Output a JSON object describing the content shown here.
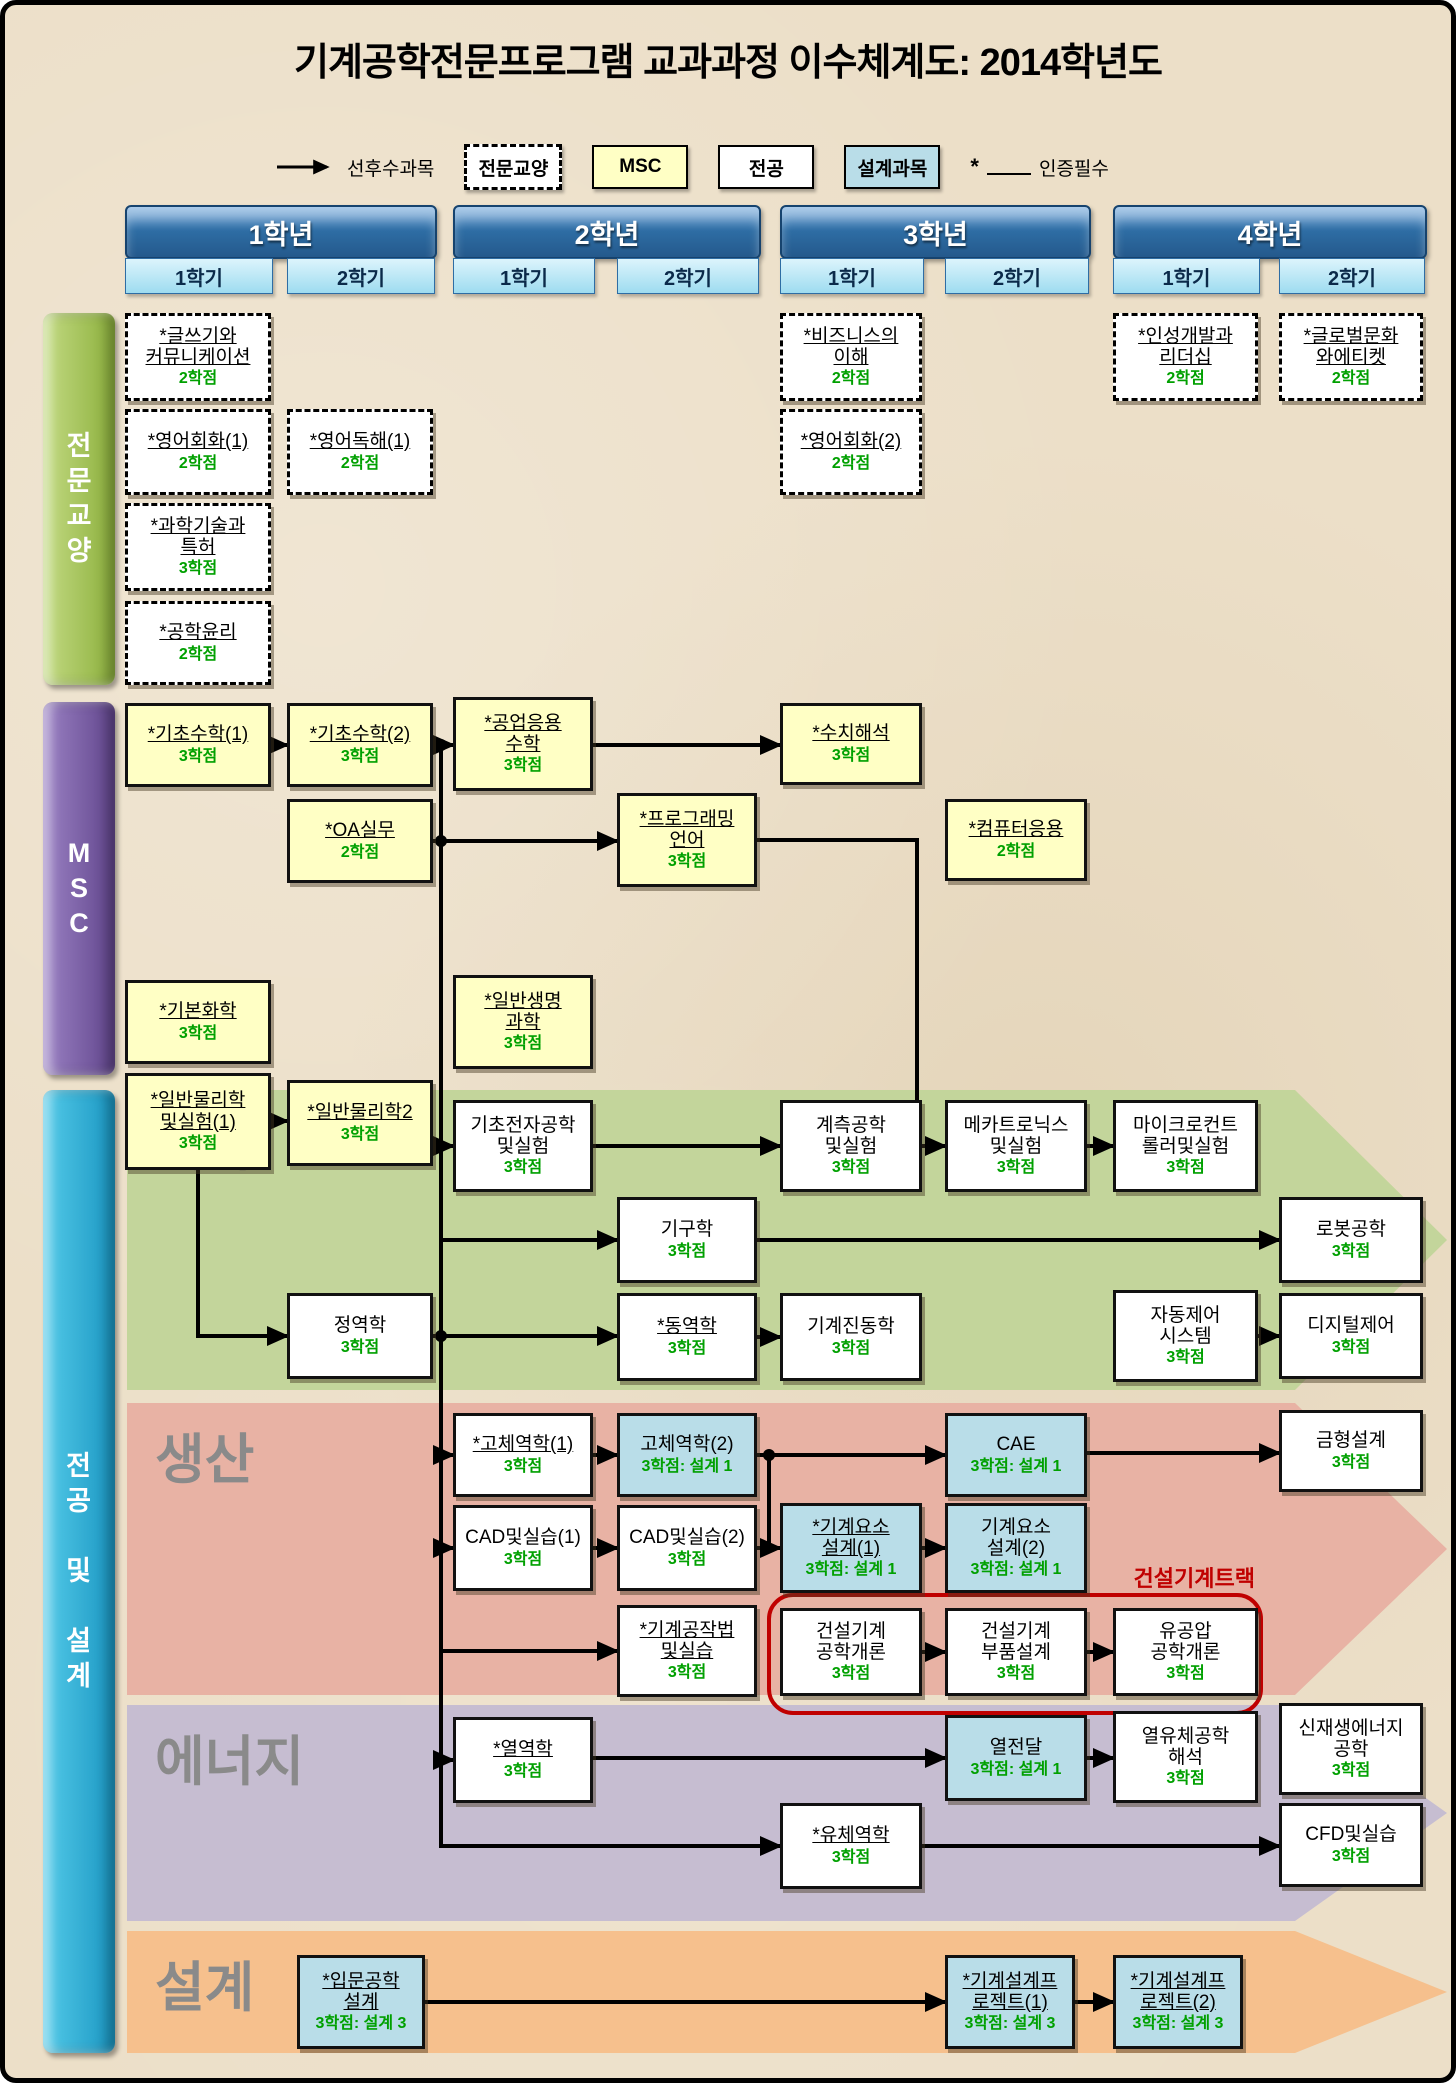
{
  "title": "기계공학전문프로그램 교과과정 이수체계도: 2014학년도",
  "legend": {
    "arrow_label": "선후수과목",
    "ge_label": "전문교양",
    "msc_label": "MSC",
    "major_label": "전공",
    "design_label": "설계과목",
    "star": "*",
    "cert_label": "인증필수"
  },
  "sidebars": {
    "ge": "전\n문\n교\n양",
    "msc": "M\nS\nC",
    "major": "전\n공\n\n및\n\n설\n계"
  },
  "colors": {
    "background": "#ecdfc8",
    "msc_yellow": "#ffffc5",
    "design_blue": "#b9dde8",
    "credit_green": "#00a000",
    "track_red": "#c00000",
    "band_meca": "#c3d59b",
    "band_prod": "#e8b2a4",
    "band_energy": "#c6bdd1",
    "band_design": "#f6c08d",
    "year_blue": "#2e6da4",
    "semester_blue": "#9edcf0"
  },
  "years": [
    {
      "label": "1학년",
      "x": 120,
      "w": 308,
      "sems": [
        {
          "label": "1학기",
          "x": 120,
          "w": 146
        },
        {
          "label": "2학기",
          "x": 282,
          "w": 146
        }
      ]
    },
    {
      "label": "2학년",
      "x": 448,
      "w": 304,
      "sems": [
        {
          "label": "1학기",
          "x": 448,
          "w": 140
        },
        {
          "label": "2학기",
          "x": 612,
          "w": 140
        }
      ]
    },
    {
      "label": "3학년",
      "x": 775,
      "w": 307,
      "sems": [
        {
          "label": "1학기",
          "x": 775,
          "w": 142
        },
        {
          "label": "2학기",
          "x": 940,
          "w": 142
        }
      ]
    },
    {
      "label": "4학년",
      "x": 1108,
      "w": 310,
      "sems": [
        {
          "label": "1학기",
          "x": 1108,
          "w": 145
        },
        {
          "label": "2학기",
          "x": 1274,
          "w": 144
        }
      ]
    }
  ],
  "cols": [
    {
      "x": 120,
      "w": 146
    },
    {
      "x": 282,
      "w": 146
    },
    {
      "x": 448,
      "w": 140
    },
    {
      "x": 612,
      "w": 140
    },
    {
      "x": 775,
      "w": 142
    },
    {
      "x": 940,
      "w": 142
    },
    {
      "x": 1108,
      "w": 145
    },
    {
      "x": 1274,
      "w": 144
    }
  ],
  "bands": [
    {
      "id": "meca",
      "label": "메카",
      "y": 1085,
      "h": 300,
      "color": "#c3d59b"
    },
    {
      "id": "prod",
      "label": "생산",
      "y": 1398,
      "h": 292,
      "color": "#e8b2a4"
    },
    {
      "id": "energy",
      "label": "에너지",
      "y": 1700,
      "h": 216,
      "color": "#c6bdd1"
    },
    {
      "id": "design",
      "label": "설계",
      "y": 1926,
      "h": 122,
      "color": "#f6c08d"
    }
  ],
  "band_shape": {
    "body_left": 122,
    "body_right": 1290,
    "tip_x": 1442
  },
  "track": {
    "label": "건설기계트랙",
    "x": 762,
    "y": 1588,
    "w": 488,
    "h": 114,
    "label_x": 1030,
    "label_y": 1556
  },
  "courses": [
    {
      "id": "writing",
      "kind": "ge",
      "col": 0,
      "y": 308,
      "h": 88,
      "starred": true,
      "lines": "*글쓰기와\n커뮤니케이션",
      "credit": "2학점"
    },
    {
      "id": "english-conv-1",
      "kind": "ge",
      "col": 0,
      "y": 404,
      "h": 86,
      "starred": true,
      "lines": "*영어회화(1)",
      "credit": "2학점"
    },
    {
      "id": "english-read-1",
      "kind": "ge",
      "col": 1,
      "y": 404,
      "h": 86,
      "starred": true,
      "lines": "*영어독해(1)",
      "credit": "2학점"
    },
    {
      "id": "sci-patent",
      "kind": "ge",
      "col": 0,
      "y": 498,
      "h": 88,
      "starred": true,
      "lines": "*과학기술과\n특허",
      "credit": "3학점"
    },
    {
      "id": "engineering-ethics",
      "kind": "ge",
      "col": 0,
      "y": 596,
      "h": 84,
      "starred": true,
      "lines": "*공학윤리",
      "credit": "2학점"
    },
    {
      "id": "business",
      "kind": "ge",
      "col": 4,
      "y": 308,
      "h": 88,
      "starred": true,
      "lines": "*비즈니스의\n이해",
      "credit": "2학점"
    },
    {
      "id": "english-conv-2",
      "kind": "ge",
      "col": 4,
      "y": 404,
      "h": 86,
      "starred": true,
      "lines": "*영어회화(2)",
      "credit": "2학점"
    },
    {
      "id": "leadership",
      "kind": "ge",
      "col": 6,
      "y": 308,
      "h": 88,
      "starred": true,
      "lines": "*인성개발과\n리더십",
      "credit": "2학점"
    },
    {
      "id": "global-culture",
      "kind": "ge",
      "col": 7,
      "y": 308,
      "h": 88,
      "starred": true,
      "lines": "*글로벌문화\n와에티켓",
      "credit": "2학점"
    },
    {
      "id": "math-1",
      "kind": "msc",
      "col": 0,
      "y": 698,
      "h": 84,
      "starred": true,
      "lines": "*기초수학(1)",
      "credit": "3학점"
    },
    {
      "id": "math-2",
      "kind": "msc",
      "col": 1,
      "y": 698,
      "h": 84,
      "starred": true,
      "lines": "*기초수학(2)",
      "credit": "3학점"
    },
    {
      "id": "eng-math",
      "kind": "msc",
      "col": 2,
      "y": 692,
      "h": 94,
      "starred": true,
      "lines": "*공업응용\n수학",
      "credit": "3학점"
    },
    {
      "id": "numerical",
      "kind": "msc",
      "col": 4,
      "y": 698,
      "h": 82,
      "starred": true,
      "lines": "*수치해석",
      "credit": "3학점"
    },
    {
      "id": "oa",
      "kind": "msc",
      "col": 1,
      "y": 794,
      "h": 84,
      "starred": true,
      "lines": "*OA실무",
      "credit": "2학점"
    },
    {
      "id": "programming",
      "kind": "msc",
      "col": 3,
      "y": 788,
      "h": 94,
      "starred": true,
      "lines": "*프로그래밍\n언어",
      "credit": "3학점"
    },
    {
      "id": "computer-app",
      "kind": "msc",
      "col": 5,
      "y": 794,
      "h": 82,
      "starred": true,
      "lines": "*컴퓨터응용",
      "credit": "2학점"
    },
    {
      "id": "chemistry",
      "kind": "msc",
      "col": 0,
      "y": 975,
      "h": 84,
      "starred": true,
      "lines": "*기본화학",
      "credit": "3학점"
    },
    {
      "id": "life-science",
      "kind": "msc",
      "col": 2,
      "y": 970,
      "h": 94,
      "starred": true,
      "lines": "*일반생명\n과학",
      "credit": "3학점"
    },
    {
      "id": "physics-1",
      "kind": "msc",
      "col": 0,
      "y": 1068,
      "h": 97,
      "starred": true,
      "lines": "*일반물리학\n및실험(1)",
      "credit": "3학점"
    },
    {
      "id": "physics-2",
      "kind": "msc",
      "col": 1,
      "y": 1075,
      "h": 86,
      "starred": true,
      "lines": "*일반물리학2",
      "credit": "3학점"
    },
    {
      "id": "electronics",
      "kind": "major",
      "col": 2,
      "y": 1095,
      "h": 92,
      "lines": "기초전자공학\n및실험",
      "credit": "3학점"
    },
    {
      "id": "measurement",
      "kind": "major",
      "col": 4,
      "y": 1095,
      "h": 92,
      "lines": "계측공학\n및실험",
      "credit": "3학점"
    },
    {
      "id": "mechatronics",
      "kind": "major",
      "col": 5,
      "y": 1095,
      "h": 92,
      "lines": "메카트로닉스\n및실험",
      "credit": "3학점"
    },
    {
      "id": "microcontroller",
      "kind": "major",
      "col": 6,
      "y": 1095,
      "h": 92,
      "lines": "마이크로컨트\n롤러및실험",
      "credit": "3학점"
    },
    {
      "id": "kinematics",
      "kind": "major",
      "col": 3,
      "y": 1192,
      "h": 86,
      "lines": "기구학",
      "credit": "3학점"
    },
    {
      "id": "robotics",
      "kind": "major",
      "col": 7,
      "y": 1192,
      "h": 86,
      "lines": "로봇공학",
      "credit": "3학점"
    },
    {
      "id": "statics",
      "kind": "major",
      "col": 1,
      "y": 1288,
      "h": 86,
      "lines": "정역학",
      "credit": "3학점"
    },
    {
      "id": "dynamics",
      "kind": "major",
      "col": 3,
      "y": 1288,
      "h": 88,
      "starred": true,
      "lines": "*동역학",
      "credit": "3학점"
    },
    {
      "id": "vibration",
      "kind": "major",
      "col": 4,
      "y": 1288,
      "h": 88,
      "lines": "기계진동학",
      "credit": "3학점"
    },
    {
      "id": "auto-control",
      "kind": "major",
      "col": 6,
      "y": 1285,
      "h": 92,
      "lines": "자동제어\n시스템",
      "credit": "3학점"
    },
    {
      "id": "digital-control",
      "kind": "major",
      "col": 7,
      "y": 1288,
      "h": 86,
      "lines": "디지털제어",
      "credit": "3학점"
    },
    {
      "id": "solid-1",
      "kind": "major",
      "col": 2,
      "y": 1408,
      "h": 84,
      "starred": true,
      "lines": "*고체역학(1)",
      "credit": "3학점"
    },
    {
      "id": "solid-2",
      "kind": "design",
      "col": 3,
      "y": 1408,
      "h": 84,
      "lines": "고체역학(2)",
      "credit": "3학점: 설계 1"
    },
    {
      "id": "cae",
      "kind": "design",
      "col": 5,
      "y": 1408,
      "h": 84,
      "lines": "CAE",
      "credit": "3학점: 설계 1"
    },
    {
      "id": "mold-design",
      "kind": "major",
      "col": 7,
      "y": 1405,
      "h": 82,
      "lines": "금형설계",
      "credit": "3학점"
    },
    {
      "id": "cad-1",
      "kind": "major",
      "col": 2,
      "y": 1500,
      "h": 86,
      "lines": "CAD및실습(1)",
      "credit": "3학점"
    },
    {
      "id": "cad-2",
      "kind": "major",
      "col": 3,
      "y": 1500,
      "h": 86,
      "lines": "CAD및실습(2)",
      "credit": "3학점"
    },
    {
      "id": "machine-elem-1",
      "kind": "design",
      "col": 4,
      "y": 1498,
      "h": 90,
      "starred": true,
      "lines": "*기계요소\n설계(1)",
      "credit": "3학점: 설계 1"
    },
    {
      "id": "machine-elem-2",
      "kind": "design",
      "col": 5,
      "y": 1498,
      "h": 90,
      "lines": "기계요소\n설계(2)",
      "credit": "3학점: 설계 1"
    },
    {
      "id": "machining",
      "kind": "major",
      "col": 3,
      "y": 1600,
      "h": 92,
      "starred": true,
      "lines": "*기계공작법\n및실습",
      "credit": "3학점"
    },
    {
      "id": "construction-intro",
      "kind": "major",
      "col": 4,
      "y": 1603,
      "h": 88,
      "lines": "건설기계\n공학개론",
      "credit": "3학점"
    },
    {
      "id": "construction-parts",
      "kind": "major",
      "col": 5,
      "y": 1603,
      "h": 88,
      "lines": "건설기계\n부품설계",
      "credit": "3학점"
    },
    {
      "id": "hydraulics",
      "kind": "major",
      "col": 6,
      "y": 1603,
      "h": 88,
      "lines": "유공압\n공학개론",
      "credit": "3학점"
    },
    {
      "id": "thermodynamics",
      "kind": "major",
      "col": 2,
      "y": 1712,
      "h": 86,
      "starred": true,
      "lines": "*열역학",
      "credit": "3학점"
    },
    {
      "id": "heat-transfer",
      "kind": "design",
      "col": 5,
      "y": 1710,
      "h": 86,
      "lines": "열전달",
      "credit": "3학점: 설계 1"
    },
    {
      "id": "thermofluid",
      "kind": "major",
      "col": 6,
      "y": 1706,
      "h": 92,
      "lines": "열유체공학\n해석",
      "credit": "3학점"
    },
    {
      "id": "renewable",
      "kind": "major",
      "col": 7,
      "y": 1698,
      "h": 92,
      "lines": "신재생에너지\n공학",
      "credit": "3학점"
    },
    {
      "id": "fluid-mechanics",
      "kind": "major",
      "col": 4,
      "y": 1798,
      "h": 86,
      "starred": true,
      "lines": "*유체역학",
      "credit": "3학점"
    },
    {
      "id": "cfd",
      "kind": "major",
      "col": 7,
      "y": 1798,
      "h": 84,
      "lines": "CFD및실습",
      "credit": "3학점"
    },
    {
      "id": "intro-design",
      "kind": "design",
      "x": 292,
      "w": 128,
      "y": 1950,
      "h": 94,
      "starred": true,
      "lines": "*입문공학\n설계",
      "credit": "3학점: 설계 3"
    },
    {
      "id": "design-project-1",
      "kind": "design",
      "col": 5,
      "w": 130,
      "y": 1950,
      "h": 94,
      "starred": true,
      "lines": "*기계설계프\n로젝트(1)",
      "credit": "3학점: 설계 3"
    },
    {
      "id": "design-project-2",
      "kind": "design",
      "col": 6,
      "w": 130,
      "y": 1950,
      "h": 94,
      "starred": true,
      "lines": "*기계설계프\n로젝트(2)",
      "credit": "3학점: 설계 3"
    }
  ],
  "arrows": [
    {
      "p": [
        [
          266,
          740
        ],
        [
          282,
          740
        ]
      ],
      "h": 1
    },
    {
      "p": [
        [
          428,
          740
        ],
        [
          448,
          740
        ]
      ],
      "h": 1
    },
    {
      "p": [
        [
          588,
          740
        ],
        [
          775,
          740
        ]
      ],
      "h": 1
    },
    {
      "p": [
        [
          428,
          836
        ],
        [
          612,
          836
        ]
      ],
      "h": 1
    },
    {
      "p": [
        [
          266,
          1116
        ],
        [
          282,
          1116
        ]
      ],
      "h": 1
    },
    {
      "p": [
        [
          436,
          740
        ],
        [
          436,
          1841
        ],
        [
          775,
          1841
        ]
      ],
      "h": 1
    },
    {
      "p": [
        [
          436,
          1141
        ],
        [
          448,
          1141
        ]
      ],
      "h": 1
    },
    {
      "p": [
        [
          436,
          1235
        ],
        [
          612,
          1235
        ]
      ],
      "h": 1
    },
    {
      "p": [
        [
          436,
          1450
        ],
        [
          448,
          1450
        ]
      ],
      "h": 1
    },
    {
      "p": [
        [
          436,
          1543
        ],
        [
          448,
          1543
        ]
      ],
      "h": 1
    },
    {
      "p": [
        [
          436,
          1646
        ],
        [
          612,
          1646
        ]
      ],
      "h": 1
    },
    {
      "p": [
        [
          436,
          1755
        ],
        [
          448,
          1755
        ]
      ],
      "h": 1
    },
    {
      "p": [
        [
          193,
          1165
        ],
        [
          193,
          1331
        ],
        [
          282,
          1331
        ]
      ],
      "h": 1
    },
    {
      "p": [
        [
          428,
          1331
        ],
        [
          612,
          1331
        ]
      ],
      "h": 1
    },
    {
      "p": [
        [
          752,
          1332
        ],
        [
          775,
          1332
        ]
      ],
      "h": 1
    },
    {
      "p": [
        [
          588,
          1141
        ],
        [
          775,
          1141
        ]
      ],
      "h": 1
    },
    {
      "p": [
        [
          752,
          835
        ],
        [
          912,
          835
        ],
        [
          912,
          1141
        ],
        [
          917,
          1141
        ]
      ],
      "h": 0
    },
    {
      "p": [
        [
          917,
          1141
        ],
        [
          940,
          1141
        ]
      ],
      "h": 1
    },
    {
      "p": [
        [
          1082,
          1141
        ],
        [
          1108,
          1141
        ]
      ],
      "h": 1
    },
    {
      "p": [
        [
          752,
          1235
        ],
        [
          1274,
          1235
        ]
      ],
      "h": 1
    },
    {
      "p": [
        [
          1253,
          1331
        ],
        [
          1274,
          1331
        ]
      ],
      "h": 1
    },
    {
      "p": [
        [
          588,
          1450
        ],
        [
          612,
          1450
        ]
      ],
      "h": 1
    },
    {
      "p": [
        [
          752,
          1450
        ],
        [
          940,
          1450
        ]
      ],
      "h": 1
    },
    {
      "p": [
        [
          764,
          1450
        ],
        [
          764,
          1543
        ]
      ],
      "h": 0
    },
    {
      "p": [
        [
          752,
          1543
        ],
        [
          775,
          1543
        ]
      ],
      "h": 1
    },
    {
      "p": [
        [
          1082,
          1448
        ],
        [
          1274,
          1448
        ]
      ],
      "h": 1
    },
    {
      "p": [
        [
          588,
          1543
        ],
        [
          612,
          1543
        ]
      ],
      "h": 1
    },
    {
      "p": [
        [
          917,
          1543
        ],
        [
          940,
          1543
        ]
      ],
      "h": 1
    },
    {
      "p": [
        [
          917,
          1647
        ],
        [
          940,
          1647
        ]
      ],
      "h": 1
    },
    {
      "p": [
        [
          1082,
          1647
        ],
        [
          1108,
          1647
        ]
      ],
      "h": 1
    },
    {
      "p": [
        [
          588,
          1753
        ],
        [
          940,
          1753
        ]
      ],
      "h": 1
    },
    {
      "p": [
        [
          1082,
          1753
        ],
        [
          1108,
          1753
        ]
      ],
      "h": 1
    },
    {
      "p": [
        [
          917,
          1841
        ],
        [
          1274,
          1841
        ]
      ],
      "h": 1
    },
    {
      "p": [
        [
          420,
          1997
        ],
        [
          940,
          1997
        ]
      ],
      "h": 1
    },
    {
      "p": [
        [
          1070,
          1997
        ],
        [
          1108,
          1997
        ]
      ],
      "h": 1
    }
  ],
  "junction_dots": [
    [
      436,
      740
    ],
    [
      436,
      836
    ],
    [
      436,
      1331
    ],
    [
      764,
      1450
    ]
  ]
}
